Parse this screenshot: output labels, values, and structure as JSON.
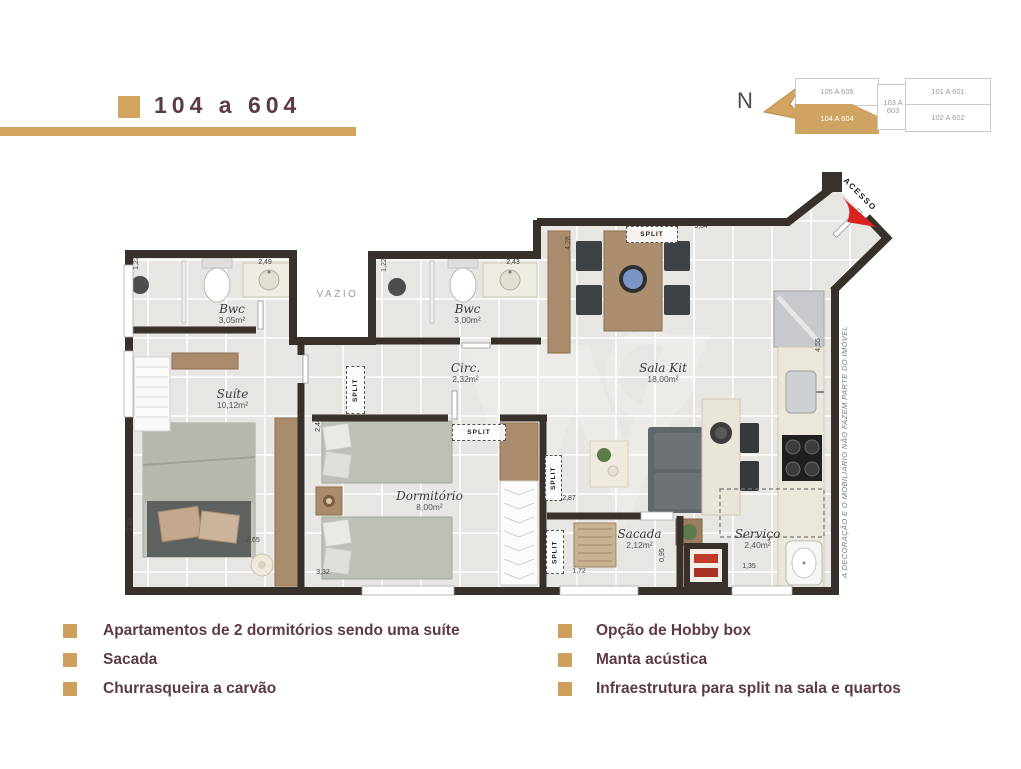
{
  "title": {
    "label": "104 a 604"
  },
  "compass": {
    "label": "N"
  },
  "key_plan": {
    "units": [
      {
        "label": "105 A 605",
        "highlighted": false
      },
      {
        "label": "104 A 604",
        "highlighted": true
      },
      {
        "label": "103 A 603",
        "highlighted": false
      },
      {
        "label": "101 A 601",
        "highlighted": false
      },
      {
        "label": "102 A 602",
        "highlighted": false
      }
    ]
  },
  "floor_plan": {
    "access_label": "ACESSO",
    "void_label": "VAZIO",
    "split_label": "SPLIT",
    "disclaimer": "A DECORAÇÃO E O MOBILIÁRIO NÃO FAZEM PARTE DO IMÓVEL",
    "rooms": [
      {
        "name": "Bwc",
        "area": "3,05m²"
      },
      {
        "name": "Suíte",
        "area": "10,12m²"
      },
      {
        "name": "Bwc",
        "area": "3,00m²"
      },
      {
        "name": "Circ.",
        "area": "2,32m²"
      },
      {
        "name": "Sala Kit",
        "area": "18,00m²"
      },
      {
        "name": "Dormitório",
        "area": "8,00m²"
      },
      {
        "name": "Sacada",
        "area": "2,12m²"
      },
      {
        "name": "Serviço",
        "area": "2,40m²"
      }
    ],
    "dimensions": [
      "1,22",
      "2,49",
      "1,22",
      "2,43",
      "4,28",
      "3,64",
      "4,55",
      "3,50",
      "2,65",
      "2,40",
      "3,32",
      "2,87",
      "1,72",
      "0,95",
      "1,35"
    ]
  },
  "features": {
    "left": [
      "Apartamentos de 2  dormitórios sendo uma suíte",
      "Sacada",
      "Churrasqueira a carvão"
    ],
    "right": [
      "Opção de Hobby box",
      "Manta acústica",
      "Infraestrutura para split na sala e quartos"
    ]
  },
  "colors": {
    "accent_tan": "#d2a45f",
    "text_maroon": "#5c3b45",
    "wall": "#38302b",
    "access_arrow_red": "#d92121"
  }
}
